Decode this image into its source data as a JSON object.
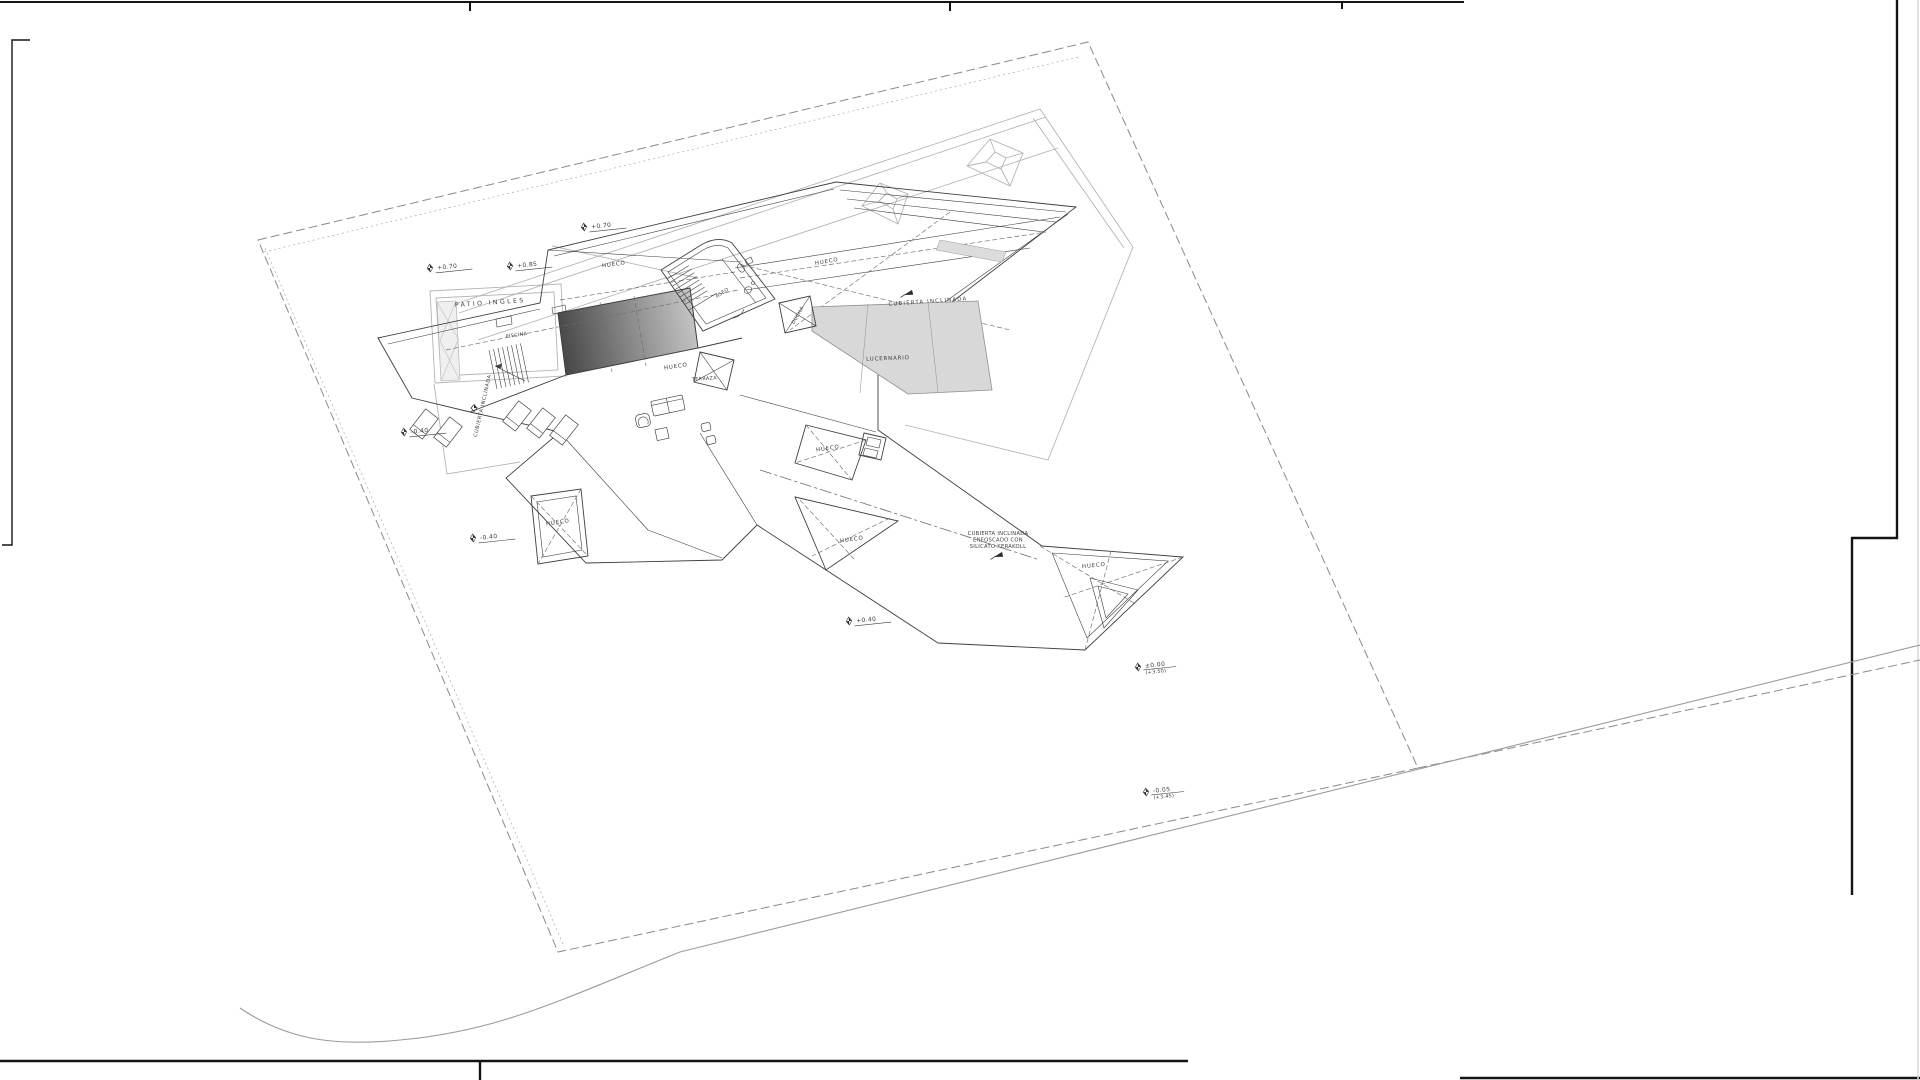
{
  "sheet": {
    "title": "roof-plan-architectural-drawing",
    "background": "#ffffff",
    "frame_color": "#141414"
  },
  "plan": {
    "room_labels": {
      "patio_ingles": "PATIO  INGLES",
      "piscina": "PISCINA",
      "terraza": "TERRAZA",
      "aseo": "ASEO",
      "ducha": "DUCHA",
      "lucernario": "LUCERNARIO",
      "hueco": "HUECO",
      "cubierta_inclinada": "CUBIERTA  INCLINADA"
    },
    "note": {
      "line1": "CUBIERTA INCLINADA",
      "line2": "ENFOSCADO CON",
      "line3": "SILICATO KERAKOLL"
    },
    "levels": {
      "m1": "+0.70",
      "m2": "+0.70",
      "m3": "+0.85",
      "m4": "-0.40",
      "m5": "-0.40",
      "m6": "+0.40",
      "m7a": "±0.00",
      "m7b": "(+3.50)",
      "m8a": "-0.05",
      "m8b": "(+3.45)"
    },
    "colors": {
      "line_dark": "#3f3f3f",
      "line_gray": "#b4b4b4",
      "boundary": "#8a8a8a",
      "pool_dark": "#454545",
      "pool_light": "#c9c9c9",
      "skylight_fill": "#d8d8d8",
      "hatch_fill": "#efefef"
    }
  }
}
